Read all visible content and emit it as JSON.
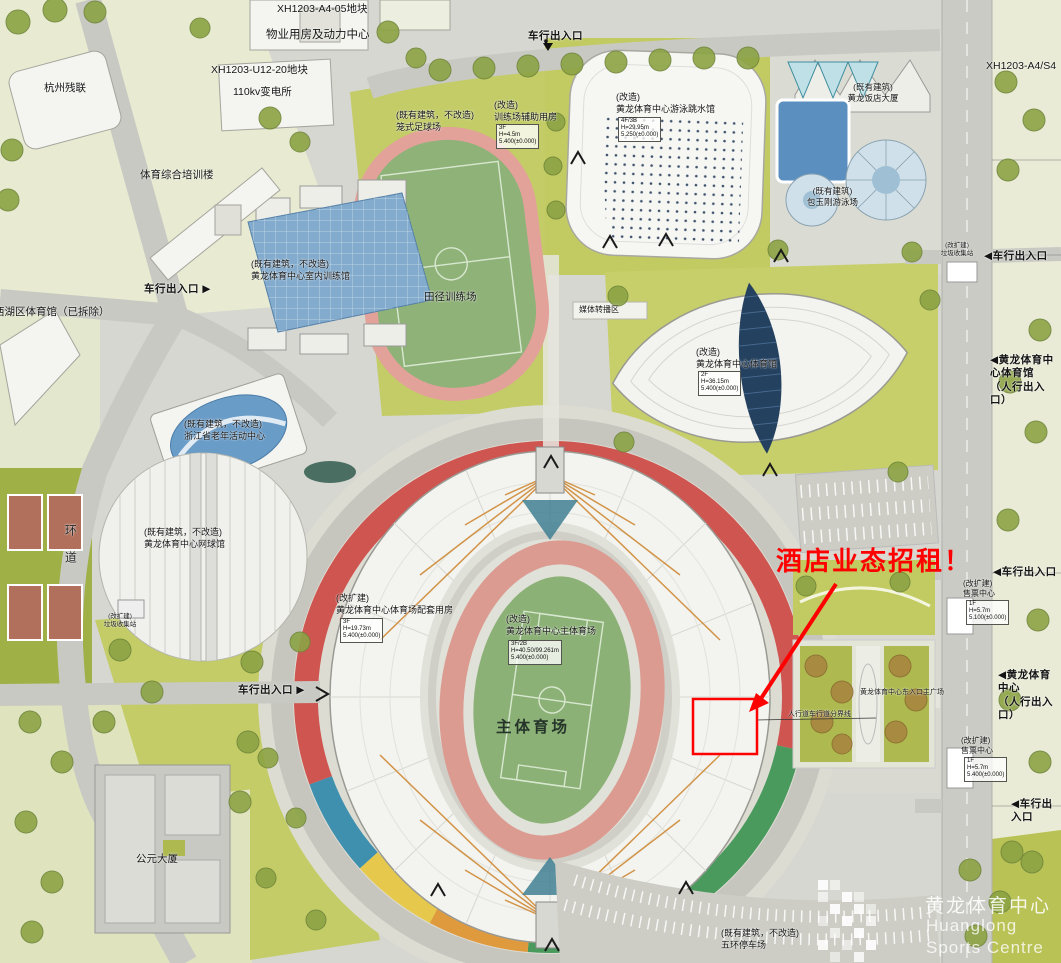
{
  "map": {
    "annotation": {
      "headline": "酒店业态招租！",
      "color": "#ff0000"
    },
    "logo": {
      "cn": "黄龙体育中心",
      "en_line1": "Huanglong",
      "en_line2": "Sports Centre"
    },
    "plots": {
      "a4_05": "XH1203-A4-05地块",
      "u12_20": "XH1203-U12-20地块",
      "a4_s4": "XH1203-A4/S4"
    },
    "icons": {
      "marker_down": "▼"
    },
    "labels": {
      "property_center": "物业用房及动力中心",
      "substation": "110kv变电所",
      "hangzhou_canlian": "杭州残联",
      "sports_training_building": "体育综合培训楼",
      "cage_football": "(既有建筑，不改造)\n笼式足球场",
      "training_aux": "(改造)\n训练场辅助用房",
      "swimming_diving_hall": "(改造)\n黄龙体育中心游泳跳水馆",
      "hotel_tower": "(既有建筑)\n黄龙饭店大厦",
      "indoor_training_hall": "(既有建筑，不改造)\n黄龙体育中心室内训练馆",
      "athletics_training_field": "田径训练场",
      "baoyugang_pool": "(既有建筑)\n包玉刚游泳场",
      "media_broadcast_zone": "媒体转播区",
      "gymnasium": "(改造)\n黄龙体育中心体育馆",
      "xihu_gym_removed": "西湖区体育馆（已拆除）",
      "elderly_center": "(既有建筑，不改造)\n浙江省老年活动中心",
      "tennis_hall": "(既有建筑，不改造)\n黄龙体育中心网球馆",
      "ring_road": "环道",
      "garbage_station_west": "(改扩建)\n垃圾收集站",
      "garbage_station_east": "(改扩建)\n垃圾收集站",
      "stadium_support": "(改扩建)\n黄龙体育中心体育场配套用房",
      "main_stadium": "(改造)\n黄龙体育中心主体育场",
      "stadium_field": "主体育场",
      "ticket_center_north": "(改扩建)\n售票中心",
      "ticket_center_south": "(改扩建)\n售票中心",
      "east_plaza": "黄龙体育中心东入口主广场",
      "boundary_note": "人行道车行道分界线",
      "gongyuan_tower": "公元大厦",
      "wuhuan_parking": "(既有建筑，不改造)\n五环停车场"
    },
    "specs": {
      "training_aux": "3F\nH=4.5m\n5.400(±0.000)",
      "swimming_diving_hall": "4F/3B\nH=29.95m\n5.250(±0.000)",
      "gymnasium": "2F\nH=36.15m\n5.400(±0.000)",
      "stadium_support": "3F\nH=19.73m\n5.400(±0.000)",
      "main_stadium": "3F/2B\nH=40.50/99.261m\n5.400(±0.000)",
      "ticket_center_north": "1F\nH=5.7m\n5.100(±0.000)",
      "ticket_center_south": "1F\nH=5.7m\n5.400(±0.000)"
    },
    "entrances": {
      "vehicle_north": "车行出入口",
      "vehicle_west_mid": "车行出入口 ▶",
      "vehicle_west_south": "车行出入口 ▶",
      "vehicle_east_north": "◀车行出入口",
      "vehicle_east_mid": "◀车行出入口",
      "vehicle_east_south": "◀车行出入口",
      "pedestrian_east_gym": "◀黄龙体育中心体育馆\n（人行出入口）",
      "pedestrian_east_plaza": "◀黄龙体育中心\n（人行出入口）"
    }
  }
}
